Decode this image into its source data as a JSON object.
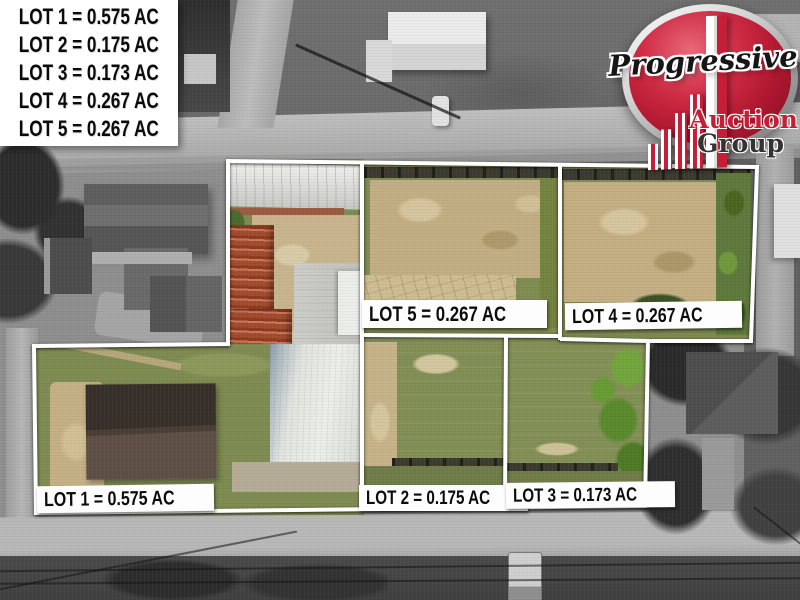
{
  "legend": {
    "items": [
      "LOT 1 = 0.575 AC",
      "LOT 2 = 0.175 AC",
      "LOT 3 = 0.173 AC",
      "LOT 4 = 0.267 AC",
      "LOT 5 = 0.267 AC"
    ]
  },
  "lots": [
    {
      "id": "lot-1",
      "label": "LOT 1 = 0.575 AC",
      "acres": 0.575
    },
    {
      "id": "lot-2",
      "label": "LOT 2 = 0.175 AC",
      "acres": 0.175
    },
    {
      "id": "lot-3",
      "label": "LOT 3 = 0.173 AC",
      "acres": 0.173
    },
    {
      "id": "lot-4",
      "label": "LOT 4 = 0.267 AC",
      "acres": 0.267
    },
    {
      "id": "lot-5",
      "label": "LOT 5 = 0.267 AC",
      "acres": 0.267
    }
  ],
  "logo": {
    "brand": "Progressive",
    "line1": "Auction",
    "line2": "Group",
    "icon": "ascending-bars-building-icon",
    "colors": {
      "brand_red": "#c51f38",
      "rim_silver": "#d6d6d6",
      "group_gray": "#333333"
    }
  },
  "overlay": {
    "boundary_color": "#ffffff",
    "label_background": "#fdfdfd",
    "label_text_color": "#0c0c0c"
  }
}
